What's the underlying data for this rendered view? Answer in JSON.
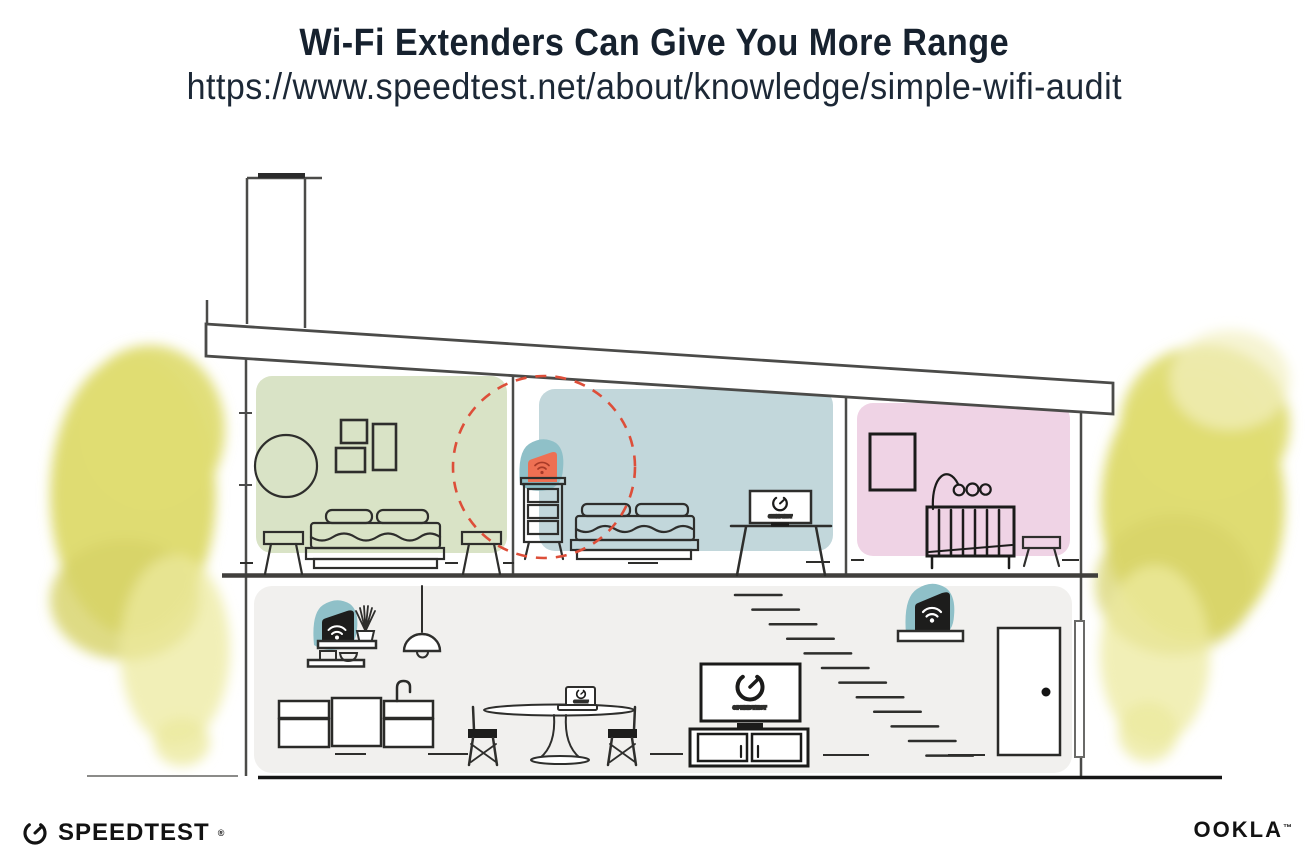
{
  "header": {
    "title": "Wi-Fi Extenders Can Give You More Range",
    "url": "https://www.speedtest.net/about/knowledge/simple-wifi-audit"
  },
  "footer": {
    "speedtest_wordmark": "SPEEDTEST",
    "speedtest_reg_mark": "®",
    "ookla_wordmark": "OOKLA",
    "ookla_tm_mark": "™"
  },
  "illustration": {
    "screen_label": "SPEEDTEST",
    "icons": {
      "wifi_device": "wifi-icon",
      "speed_gauge": "speedtest-gauge-icon"
    },
    "devices": [
      {
        "name": "wifi-extender-highlighted",
        "appearance": "orange, on bedroom dresser, dashed coverage circle"
      },
      {
        "name": "wifi-router",
        "appearance": "black, kitchen shelf"
      },
      {
        "name": "wifi-extender",
        "appearance": "black, hallway shelf by stairs"
      }
    ]
  },
  "colors": {
    "room_green": "#d9e3c6",
    "room_blue": "#c2d7db",
    "room_pink": "#efd3e5",
    "floor_gray": "#f1f0ee",
    "teal_glow": "#8fc0c8",
    "extender_orange": "#ee7053",
    "wifi_on_orange": "#a83a28",
    "dashed_circle_red": "#dd4e39",
    "foliage_yellow": "#dfdc72",
    "foliage_yellow_dark": "#d6d266",
    "foliage_yellow_light": "#ecea9f",
    "outline_gray": "#4b4b49",
    "ink_black": "#1d1d1b",
    "title_ink": "#16212e"
  }
}
